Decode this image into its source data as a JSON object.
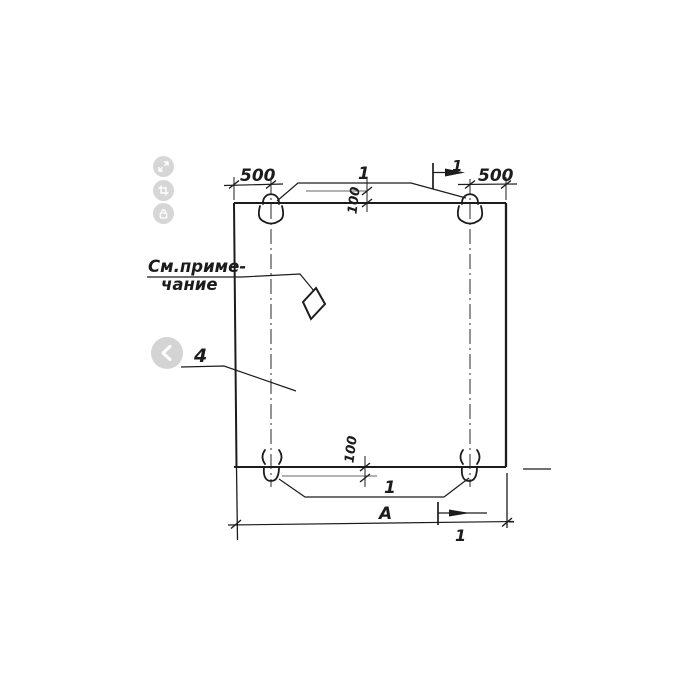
{
  "viewer_controls": {
    "buttons": [
      {
        "icon": "expand-icon"
      },
      {
        "icon": "crop-icon"
      },
      {
        "icon": "lock-icon"
      }
    ],
    "prev_button": {
      "icon": "chevron-left-icon"
    }
  },
  "drawing": {
    "dimensions": {
      "top_left": "500",
      "top_right": "500",
      "loop_protrusion_top": "100",
      "loop_protrusion_bottom": "100",
      "overall_width": "А"
    },
    "callouts": {
      "loops_top": "1",
      "loops_bottom": "1",
      "panel": "4",
      "note_line1": "См.приме-",
      "note_line2": "чание"
    },
    "section_marks": {
      "top": "1",
      "bottom": "1"
    },
    "colors": {
      "line": "#1c1c1c",
      "faint_line": "#666666",
      "button_background": "#d6d6d6",
      "button_glyph": "#ffffff"
    }
  }
}
